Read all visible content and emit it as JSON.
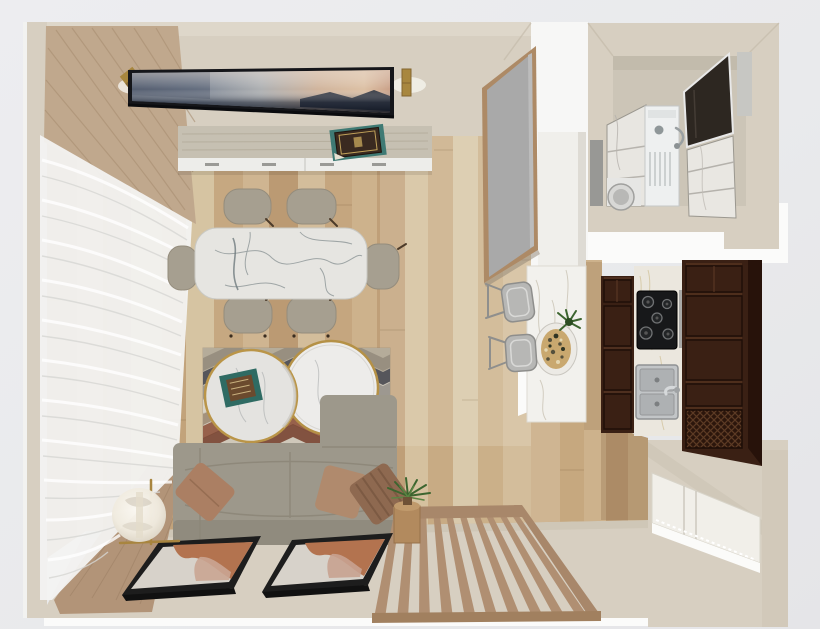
{
  "scene": {
    "title": "Top-down 3D interior render of a studio apartment",
    "view": "top-down perspective",
    "rooms_count": 4
  },
  "palette": {
    "bg": "#e9eaec",
    "bg2": "#f1f2f4",
    "white": "#fafaf9",
    "wall": "#d7cfc1",
    "wallLight": "#ded7ca",
    "wallShade": "#cfc6b6",
    "floorA": "#c9ac84",
    "floorB": "#b7976f",
    "floorC": "#d6c4a3",
    "curtain": "#c0a88d",
    "curtain2": "#b29478",
    "sheer": "#f3f3f2",
    "brass": "#a8873f",
    "console": "#c6c0b2",
    "marble": "#e6e5e1",
    "chair": "#a69f90",
    "sofa": "#9d988b",
    "rugBase": "#cfc8ba",
    "rugDark": "#56565b",
    "rugRust": "#97614b",
    "frame": "#1d1d1d",
    "artRust": "#b3734f",
    "slat": "#b08f72",
    "mirror": "#a9a9a9",
    "mirrorFrame": "#ad8a66",
    "island": "#f2f1ed",
    "cabinet": "#3a2014",
    "cabinetDeep": "#27120a",
    "counter": "#ebe7de",
    "cooktop": "#17181a",
    "steel": "#c2c5c7",
    "bathFloor": "#ccc5b7",
    "darkPanel": "#2d2721",
    "closet": "#f1efe9",
    "green": "#3e6b33",
    "lamp": "#f1ece1",
    "tvDark": "#232c3a",
    "tvPeach": "#d0b49c"
  },
  "rooms": [
    {
      "name": "living-room",
      "objects": [
        {
          "id": "tv-panel",
          "desc": "wall TV showing sunset landscape",
          "color": "#232c3a"
        },
        {
          "id": "wall-sconce-left",
          "desc": "brass sconce",
          "color": "#a8873f"
        },
        {
          "id": "wall-sconce-right",
          "desc": "brass sconce with glow",
          "color": "#a8873f"
        },
        {
          "id": "media-console",
          "desc": "wood console with white drawers",
          "color": "#c6c0b2"
        },
        {
          "id": "decor-book",
          "desc": "dark book on teal mat",
          "color": "#3f7a74"
        },
        {
          "id": "drape-curtain",
          "desc": "tan curtain drape",
          "color": "#c0a88d"
        },
        {
          "id": "sheer-curtain",
          "desc": "white sheer curtain wall",
          "color": "#f3f3f2"
        },
        {
          "id": "dining-table",
          "desc": "white marble dining table",
          "color": "#e6e5e1"
        },
        {
          "id": "dining-chair",
          "desc": "six taupe upholstered chairs",
          "count": 6,
          "color": "#a69f90"
        },
        {
          "id": "area-rug",
          "desc": "chevron zigzag rug",
          "color": "#cfc8ba"
        },
        {
          "id": "coffee-table",
          "desc": "two round marble tables, gold rim",
          "count": 2,
          "color": "#e6e5e1"
        },
        {
          "id": "decor-tray",
          "desc": "teal tray with book",
          "color": "#2f6b63"
        },
        {
          "id": "sectional-sofa",
          "desc": "gray sectional with chaise",
          "color": "#9d988b"
        },
        {
          "id": "throw-pillow",
          "desc": "tan and striped brown pillows",
          "count": 3,
          "color": "#ab7f63"
        },
        {
          "id": "floor-lamp",
          "desc": "glass globe lamp with brass frame",
          "color": "#f1ece1"
        },
        {
          "id": "framed-artwork",
          "desc": "two leaning abstract artworks",
          "count": 2,
          "color": "#b3734f"
        },
        {
          "id": "slat-screen",
          "desc": "wood slat screen leaning on wall",
          "color": "#b08f72"
        },
        {
          "id": "plant-stand",
          "desc": "wood stand with green plant",
          "color": "#b28a5e"
        },
        {
          "id": "leaning-mirror",
          "desc": "tan framed leaning mirror",
          "color": "#a9a9a9"
        }
      ]
    },
    {
      "name": "kitchen",
      "objects": [
        {
          "id": "breakfast-bar",
          "desc": "white marble bar",
          "color": "#f2f1ed"
        },
        {
          "id": "bar-stool",
          "desc": "two gray metal stools",
          "count": 2,
          "color": "#b7b7b5"
        },
        {
          "id": "serving-plate",
          "desc": "plate of food",
          "color": "#c9a86f"
        },
        {
          "id": "herb-plant",
          "desc": "green garnish plant",
          "color": "#3e6b33"
        },
        {
          "id": "cabinet-left",
          "desc": "dark espresso cabinet column",
          "color": "#3a2014"
        },
        {
          "id": "marble-counter",
          "desc": "white marble counter run",
          "color": "#ebe7de"
        },
        {
          "id": "gas-cooktop",
          "desc": "black cooktop, five burners",
          "color": "#17181a"
        },
        {
          "id": "double-sink",
          "desc": "steel double basin sink",
          "color": "#c2c5c7"
        },
        {
          "id": "cabinet-right",
          "desc": "dark cabinet block with lattice vent",
          "color": "#3a2014"
        }
      ]
    },
    {
      "name": "bathroom",
      "objects": [
        {
          "id": "shower-panel-left",
          "desc": "marble shower panel",
          "color": "#e8e6e1"
        },
        {
          "id": "washing-machine",
          "desc": "white washer, round door",
          "color": "#d8d8d6"
        },
        {
          "id": "vanity-unit",
          "desc": "white vanity with faucet",
          "color": "#eef0f0"
        },
        {
          "id": "dark-mirror-panel",
          "desc": "dark leaning panel",
          "color": "#2d2721"
        },
        {
          "id": "shower-panel-right",
          "desc": "marble shower panel",
          "color": "#e8e6e1"
        }
      ]
    },
    {
      "name": "entry",
      "objects": [
        {
          "id": "closet-doors",
          "desc": "white paneled closet doors",
          "color": "#f1efe9"
        }
      ]
    }
  ]
}
